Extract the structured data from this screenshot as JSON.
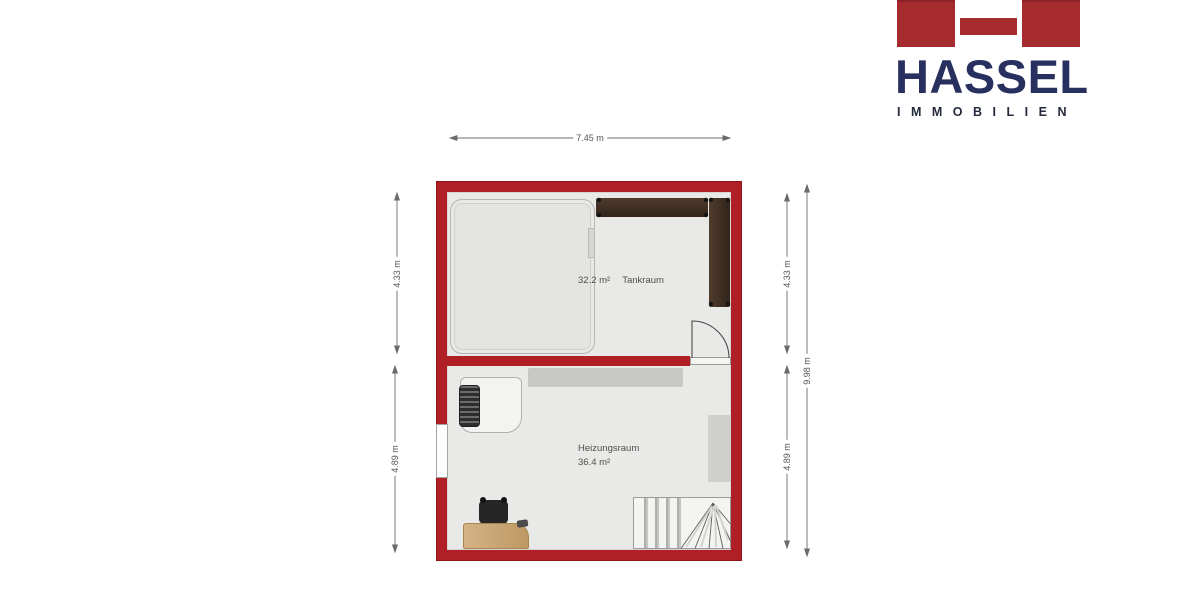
{
  "brand": {
    "name": "HASSEL",
    "subtitle": "IMMOBILIEN",
    "colors": {
      "red": "#a52b2f",
      "navy": "#28305f"
    }
  },
  "floorplan": {
    "colors": {
      "wall": "#b01f25",
      "floor": "#e9e9e8",
      "shelf_wood": "#3e2e20",
      "desk_wood": "#c9a26a"
    },
    "rooms": {
      "tankraum": {
        "area": "32.2 m²",
        "name": "Tankraum"
      },
      "heizungsraum": {
        "name": "Heizungsraum",
        "area": "36.4 m²"
      }
    },
    "dimensions": {
      "width_top": "7.45 m",
      "left_upper": "4.33 m",
      "left_lower": "4.89 m",
      "right_upper": "4.33 m",
      "right_lower": "4.89 m",
      "right_total": "9.98 m"
    }
  }
}
